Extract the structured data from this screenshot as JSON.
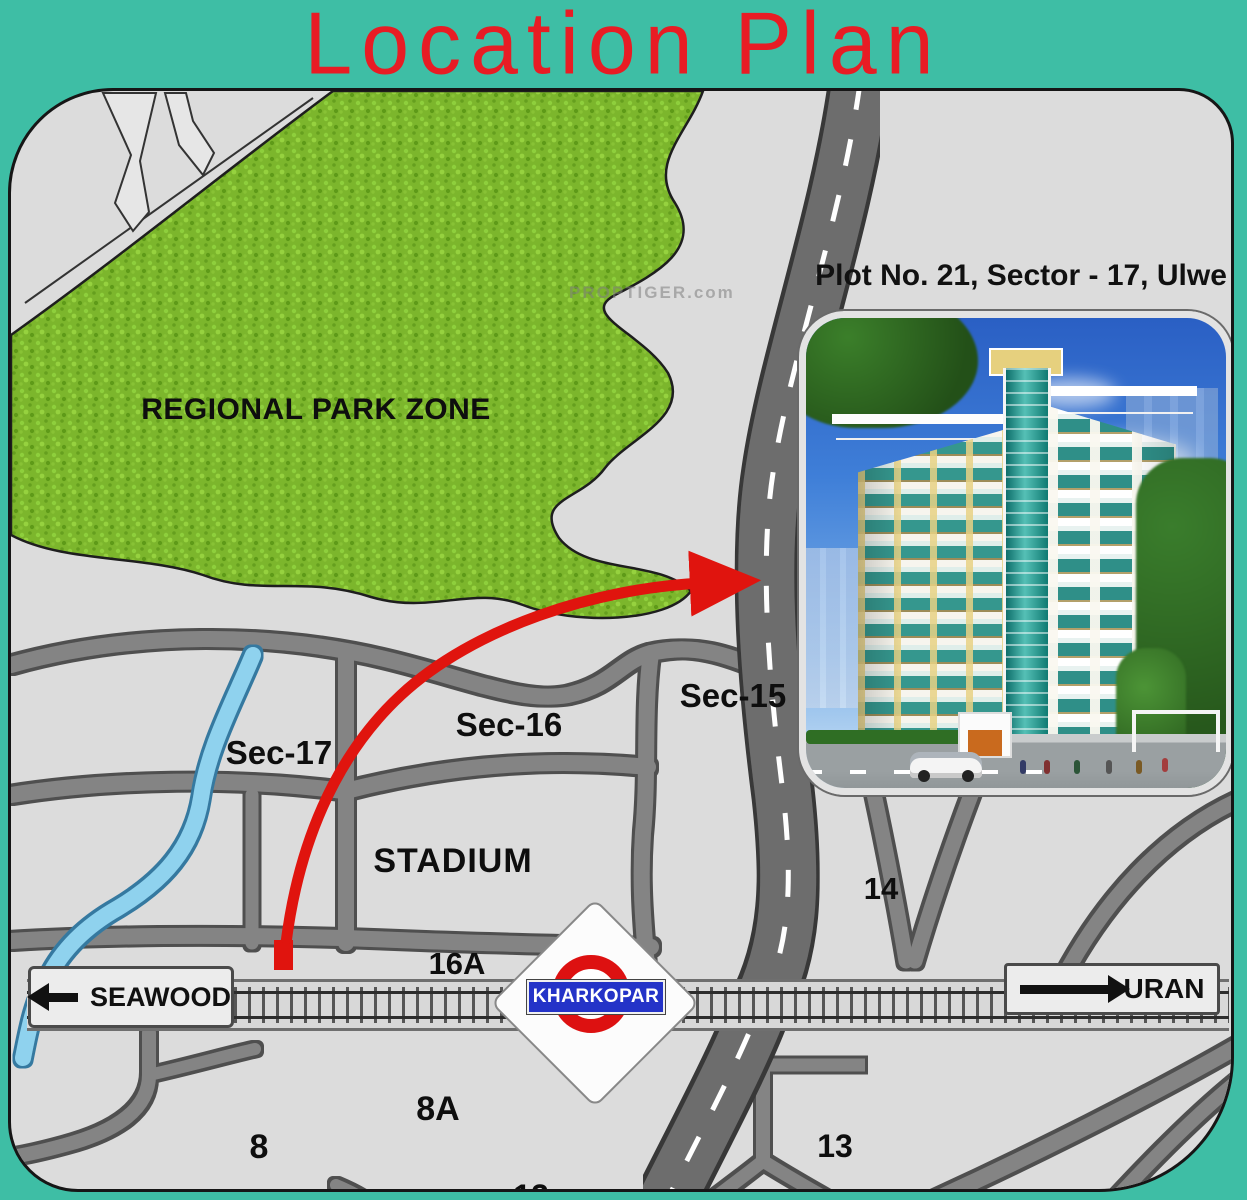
{
  "title": "Location Plan",
  "watermark": "PROPTIGER.com",
  "map": {
    "park_label": "REGIONAL PARK ZONE",
    "labels": [
      {
        "id": "sec-17",
        "text": "Sec-17"
      },
      {
        "id": "sec-16",
        "text": "Sec-16"
      },
      {
        "id": "sec-15",
        "text": "Sec-15"
      },
      {
        "id": "stadium",
        "text": "STADIUM"
      },
      {
        "id": "16a",
        "text": "16A"
      },
      {
        "id": "14",
        "text": "14"
      },
      {
        "id": "8",
        "text": "8"
      },
      {
        "id": "8a",
        "text": "8A"
      },
      {
        "id": "13",
        "text": "13"
      },
      {
        "id": "12",
        "text": "12"
      }
    ],
    "signs": {
      "seawood": {
        "label": "SEAWOOD",
        "arrow": "left"
      },
      "uran": {
        "label": "URAN",
        "arrow": "right"
      }
    },
    "station": {
      "label": "KHARKOPAR"
    }
  },
  "inset": {
    "caption": "Plot No. 21, Sector - 17, Ulwe"
  },
  "colors": {
    "background_teal": "#3ebea5",
    "title_red": "#e81c24",
    "map_gray": "#dcdcdc",
    "road_gray": "#848484",
    "highway_gray": "#6d6d6d",
    "park_green": "#7cb62c",
    "river_blue": "#8fd2ee",
    "arrow_red": "#e0140e",
    "station_banner_blue": "#2433c8",
    "station_ring_red": "#dd1111"
  }
}
